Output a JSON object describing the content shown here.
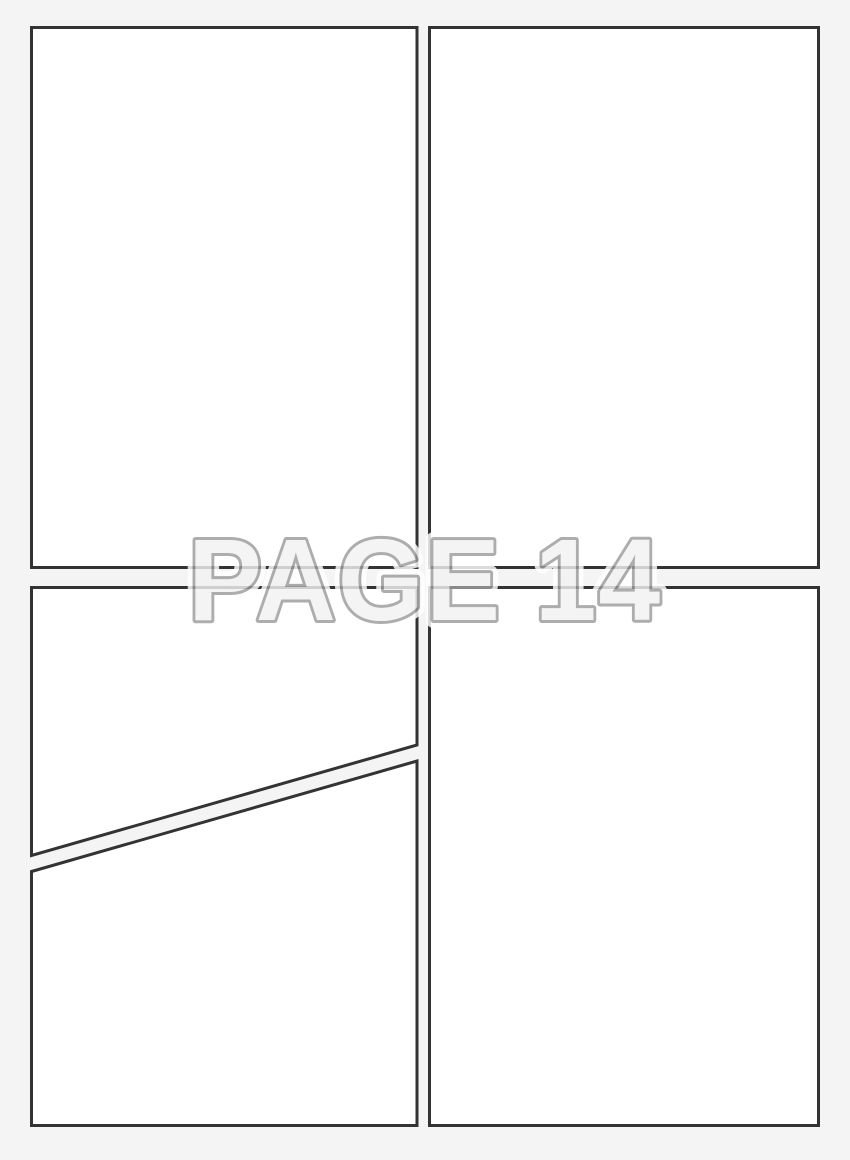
{
  "watermark": {
    "label": "PAGE 14"
  },
  "theme": {
    "page-bg": "#f4f4f4",
    "panel-fill": "#ffffff",
    "panel-border": "#333333",
    "watermark-fill": "#f2f2f2",
    "watermark-stroke": "#9c9c9c",
    "watermark-halo": "#ffffff"
  },
  "panels": [
    {
      "id": "panel-top-left"
    },
    {
      "id": "panel-top-right"
    },
    {
      "id": "panel-bottom-left-upper"
    },
    {
      "id": "panel-bottom-left-lower"
    },
    {
      "id": "panel-bottom-right"
    }
  ]
}
